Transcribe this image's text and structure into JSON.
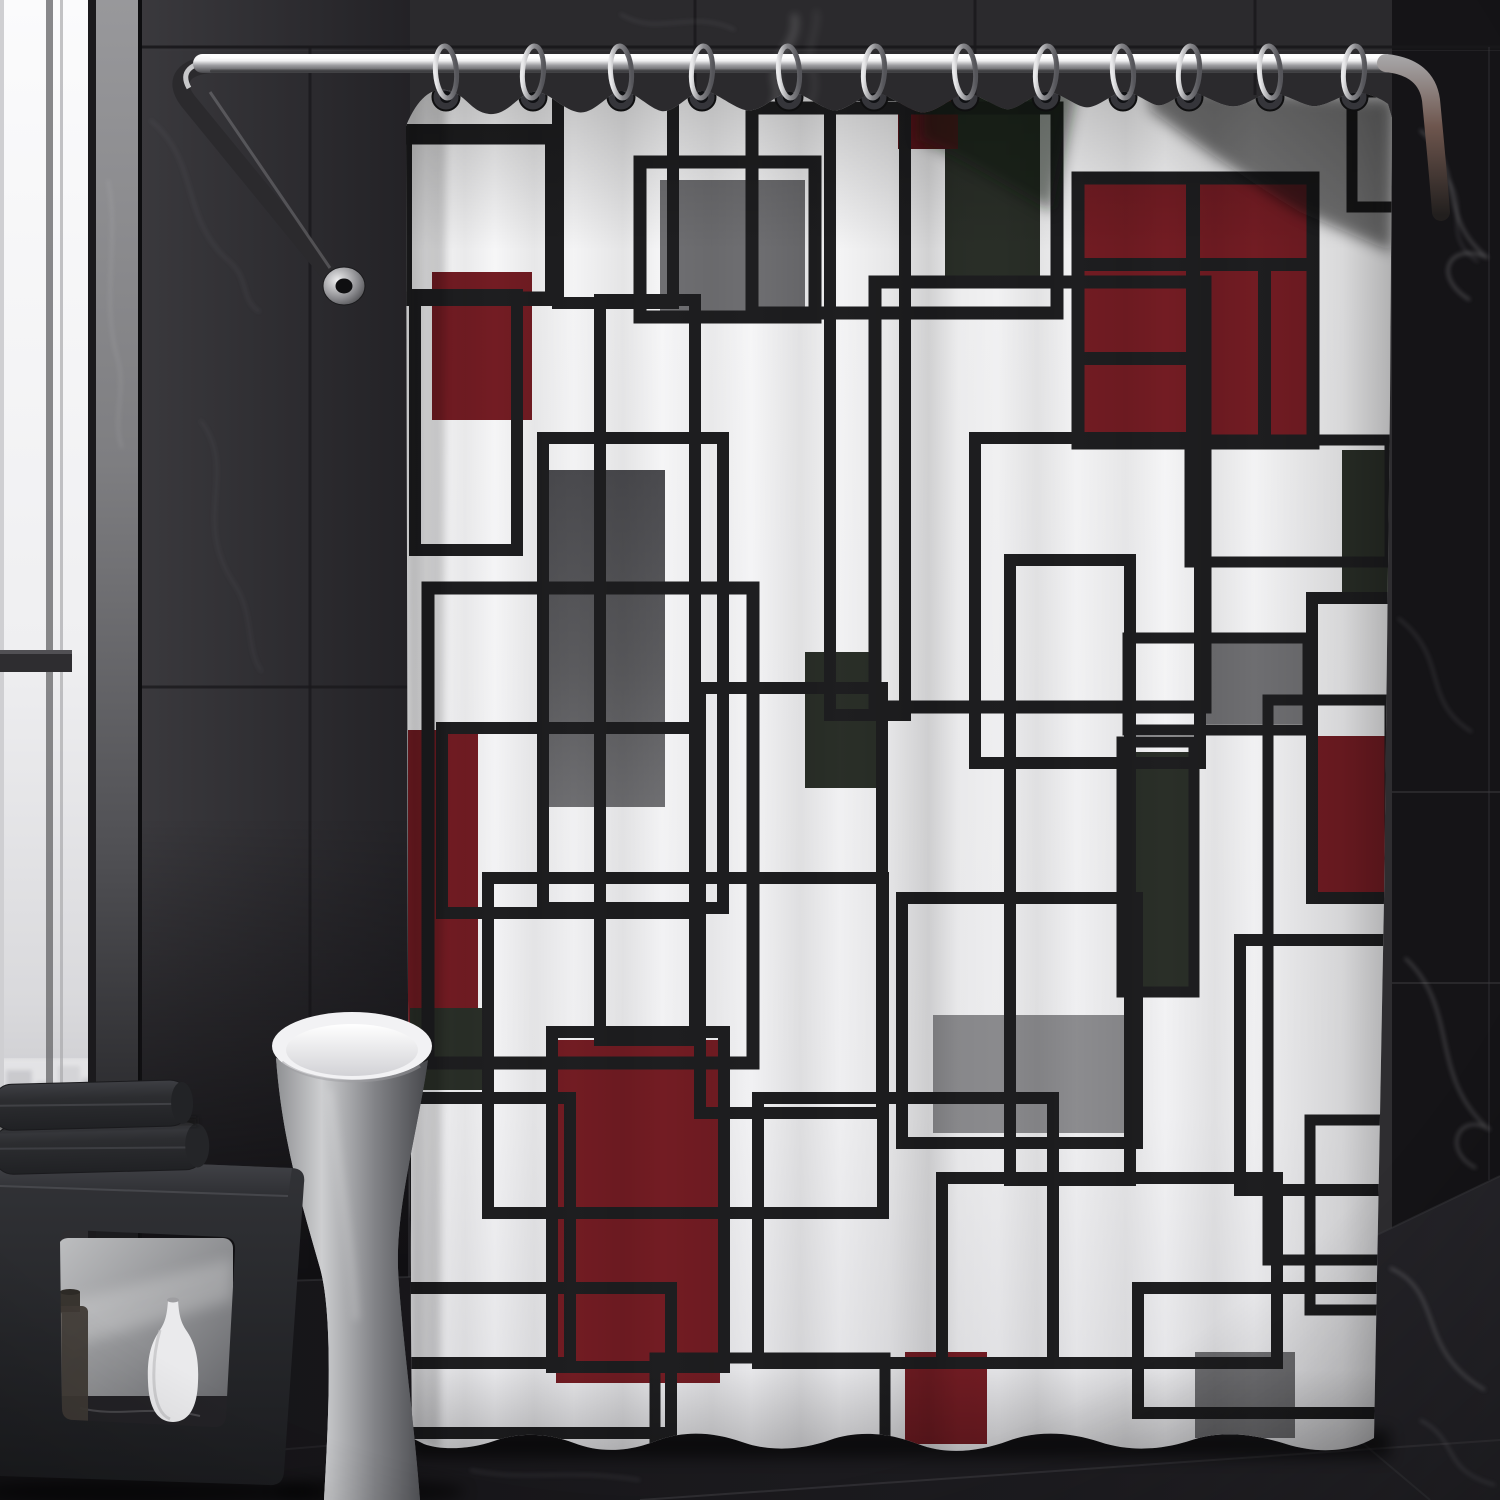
{
  "scene": {
    "description": "Dark modern bathroom with chrome curved shower rod, twelve chrome rings, white geometric Mondrian-pattern shower curtain with maroon, gray and dark green blocks, freestanding pedestal tub, black cube bench with folded dark towels, white vase and brown bottle, black marble walls and floor",
    "objects": [
      "window",
      "marble-pillar",
      "tile-wall",
      "marble-wall",
      "shower-rod",
      "rod-wall-mount",
      "curtain-rings",
      "shower-curtain",
      "steam",
      "pedestal-tub",
      "bench",
      "towels",
      "vase",
      "bottle",
      "floor"
    ]
  },
  "palette": {
    "wallTop": "#2e2d30",
    "wallLeftA": "#3a393d",
    "wallLeftB": "#232226",
    "wallRight": "#151417",
    "grout": "#19181b",
    "groutLight": "#454449",
    "windowLight": "#fbfbfc",
    "windowMid": "#d9d9dc",
    "pillarLight": "#98989b",
    "pillarDark": "#131315",
    "chromeLight": "#f1f1f3",
    "chromeMid": "#9c9ca0",
    "chromeDark": "#47474b",
    "rodBrown": "#6e564e",
    "curtainWhite": "#f7f7f8",
    "curtainShade": "#e2e2e5",
    "patternLine": "#1e1e20",
    "maroon": "#731c23",
    "maroonDeep": "#5c151b",
    "gray": "#6f6f72",
    "grayLight": "#8d8d90",
    "grayDark": "#4a4a4e",
    "green": "#2a2f28",
    "floorA": "#141316",
    "floorB": "#26252a",
    "vein": "#c9c9ce",
    "benchDark": "#1f2023",
    "benchTop": "#45464b",
    "benchPanelA": "#bdbec0",
    "benchPanelB": "#5e5f63",
    "towel": "#2c2d30",
    "towelLight": "#3e3f44",
    "tubLight": "#cdced0",
    "tubDark": "#47484c",
    "tubRim": "#f2f2f4",
    "bottle": "#3f3a35",
    "vase": "#eaeaec",
    "city": "#c9c9cd"
  },
  "curtain": {
    "rings_count": 12,
    "ring_positions": [
      446,
      533,
      621,
      702,
      789,
      874,
      965,
      1046,
      1123,
      1189,
      1270,
      1354
    ],
    "grommet_y": 97,
    "ring_cy": 72,
    "pattern": {
      "frames": [
        [
          338,
          138,
          215,
          160,
          13
        ],
        [
          406,
          130,
          145,
          170,
          12
        ],
        [
          415,
          295,
          102,
          255,
          12
        ],
        [
          558,
          88,
          115,
          215,
          12
        ],
        [
          640,
          162,
          175,
          155,
          13
        ],
        [
          752,
          108,
          305,
          205,
          13
        ],
        [
          875,
          282,
          330,
          425,
          13
        ],
        [
          543,
          438,
          180,
          470,
          12
        ],
        [
          428,
          588,
          325,
          475,
          13
        ],
        [
          488,
          878,
          395,
          335,
          12
        ],
        [
          700,
          688,
          182,
          425,
          12
        ],
        [
          975,
          438,
          225,
          325,
          12
        ],
        [
          1190,
          440,
          200,
          122,
          11
        ],
        [
          1128,
          638,
          180,
          92,
          11
        ],
        [
          1312,
          598,
          190,
          300,
          12
        ],
        [
          1122,
          742,
          72,
          250,
          11
        ],
        [
          902,
          898,
          235,
          245,
          12
        ],
        [
          1138,
          1288,
          255,
          125,
          12
        ],
        [
          552,
          1032,
          172,
          335,
          12
        ],
        [
          758,
          1098,
          295,
          265,
          12
        ],
        [
          405,
          1098,
          165,
          265,
          12
        ],
        [
          942,
          1178,
          335,
          185,
          12
        ],
        [
          1078,
          178,
          235,
          265,
          13
        ],
        [
          336,
          1288,
          335,
          145,
          12
        ],
        [
          1352,
          92,
          95,
          115,
          11
        ],
        [
          600,
          300,
          95,
          740,
          12
        ],
        [
          830,
          95,
          75,
          620,
          12
        ],
        [
          1010,
          560,
          120,
          620,
          12
        ],
        [
          442,
          728,
          258,
          185,
          12
        ],
        [
          655,
          1358,
          230,
          160,
          11
        ],
        [
          1240,
          940,
          250,
          250,
          12
        ],
        [
          1310,
          1120,
          185,
          190,
          11
        ],
        [
          1268,
          700,
          122,
          560,
          11
        ]
      ],
      "fills": [
        [
          432,
          272,
          100,
          148,
          "maroon"
        ],
        [
          660,
          180,
          145,
          133,
          "gray"
        ],
        [
          945,
          92,
          95,
          192,
          "green"
        ],
        [
          898,
          85,
          60,
          64,
          "maroonDeep"
        ],
        [
          1082,
          182,
          226,
          258,
          "maroon"
        ],
        [
          543,
          470,
          122,
          337,
          "grad:grayTall"
        ],
        [
          408,
          730,
          70,
          330,
          "maroon"
        ],
        [
          805,
          652,
          74,
          136,
          "green"
        ],
        [
          1127,
          752,
          64,
          235,
          "green"
        ],
        [
          1194,
          642,
          110,
          82,
          "gray"
        ],
        [
          1316,
          736,
          72,
          160,
          "maroon"
        ],
        [
          933,
          1015,
          198,
          118,
          "grayLight"
        ],
        [
          905,
          1352,
          82,
          92,
          "maroon"
        ],
        [
          556,
          1040,
          164,
          343,
          "maroon"
        ],
        [
          410,
          1008,
          80,
          82,
          "green"
        ],
        [
          1195,
          1352,
          100,
          86,
          "gray"
        ],
        [
          1342,
          450,
          50,
          142,
          "green"
        ]
      ],
      "grid_lines": [
        [
          1186,
          182,
          14,
          258
        ],
        [
          1082,
          258,
          226,
          13
        ],
        [
          1082,
          352,
          112,
          13
        ],
        [
          1258,
          258,
          13,
          182
        ]
      ]
    }
  }
}
